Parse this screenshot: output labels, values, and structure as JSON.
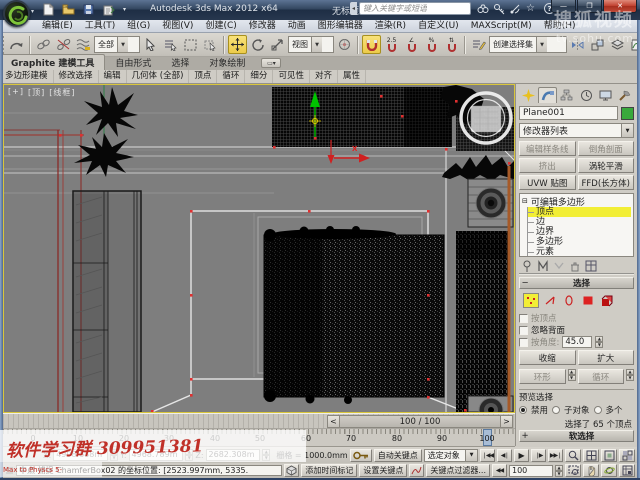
{
  "window": {
    "app_title": "Autodesk 3ds Max 2012 x64",
    "doc_title": "无标题",
    "search_placeholder": "键入关键字或短语",
    "min_glyph": "—",
    "max_glyph": "❐",
    "close_glyph": "✕"
  },
  "watermarks": {
    "top_line1": "搜狐视频",
    "top_line2": "tv.sohu.com",
    "bottom_line1": "软件学习群 309951381",
    "bottom_line2": "Max to Physcs 5-"
  },
  "menubar": {
    "items": [
      "编辑(E)",
      "工具(T)",
      "组(G)",
      "视图(V)",
      "创建(C)",
      "修改器",
      "动画",
      "图形编辑器",
      "渲染(R)",
      "自定义(U)",
      "MAXScript(M)",
      "帮助(H)"
    ]
  },
  "toolbar": {
    "selection_filter": "全部",
    "ref_coord": "视图",
    "named_selection": "创建选择集",
    "snap_25": "2.5",
    "snap_angle": "∠",
    "snap_percent": "%",
    "snap_spinner": "⇅"
  },
  "ribbon": {
    "tabs": [
      "Graphite 建模工具",
      "自由形式",
      "选择",
      "对象绘制"
    ],
    "panels": [
      "多边形建模",
      "修改选择",
      "编辑",
      "几何体 (全部)",
      "顶点",
      "循环",
      "细分",
      "可见性",
      "对齐",
      "属性"
    ]
  },
  "viewport": {
    "label_plus": "[+]",
    "label_view": "[顶]",
    "label_shading": "[线框]",
    "gizmo_x_label": "X"
  },
  "command_panel": {
    "object_name": "Plane001",
    "modifier_list": "修改器列表",
    "buttons": [
      "编辑样条线",
      "倒角剖面",
      "挤出",
      "涡轮平滑",
      "UVW 贴图",
      "FFD(长方体)"
    ],
    "stack_root": "可编辑多边形",
    "stack_items": [
      "顶点",
      "边",
      "边界",
      "多边形",
      "元素"
    ],
    "selection": {
      "title": "选择",
      "by_vertex": "按顶点",
      "ignore_backfacing": "忽略背面",
      "by_angle": "按角度:",
      "angle_value": "45.0",
      "shrink": "收缩",
      "grow": "扩大",
      "ring": "环形",
      "loop": "循环",
      "preview_title": "预览选择",
      "radio_disable": "禁用",
      "radio_subobj": "子对象",
      "radio_multi": "多个",
      "status": "选择了 65 个顶点"
    },
    "soft_selection_title": "软选择"
  },
  "timeline": {
    "slider_text": "100 / 100",
    "prev": "<",
    "next": ">",
    "tick_labels": [
      "0",
      "10",
      "20",
      "30",
      "40",
      "50",
      "60",
      "70",
      "80",
      "90",
      "100"
    ]
  },
  "status": {
    "x_label": "X:",
    "x_value": "4998.688m",
    "y_label": "Y:",
    "y_value": "4968.789m",
    "z_label": "Z:",
    "z_value": "2682.308m",
    "grid_label": "栅格 = 1000.0mm",
    "prompt": "中点 捕捉 ChamferBox02 的坐标位置: [2523.997mm, 5335.",
    "add_time_tag": "添加时间标记",
    "auto_key": "自动关键点",
    "set_key": "设置关键点",
    "selected_filter": "选定对象",
    "key_filters": "关键点过滤器...",
    "frame_field": "100"
  }
}
